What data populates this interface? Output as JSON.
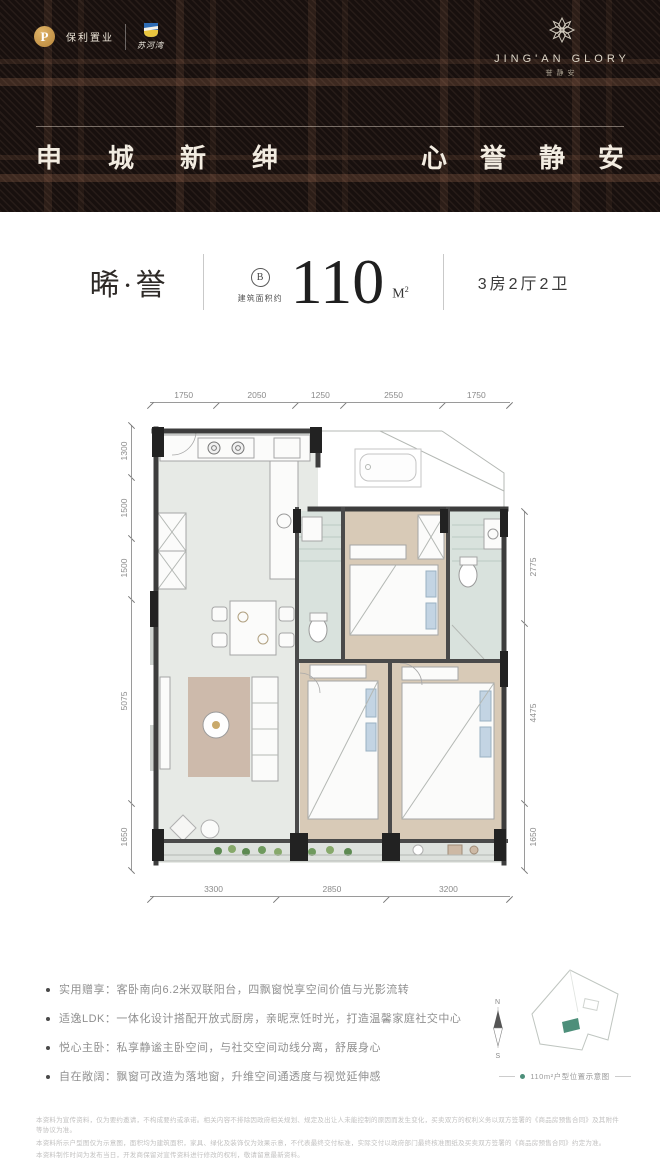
{
  "header": {
    "logo_poly_mark": "P",
    "logo_poly_label": "保利置业",
    "logo_partner_label": "苏河湾",
    "brand_name": "JING'AN GLORY",
    "brand_cn": "誉静安",
    "slogan_left": "申城新绅",
    "slogan_right": "心誉静安"
  },
  "title": {
    "product_name": "晞·誉",
    "unit_badge": "B",
    "area_label": "建筑面积约",
    "area_value": "110",
    "area_unit_main": "M",
    "area_unit_sup": "2",
    "layout": "3房2厅2卫"
  },
  "floorplan": {
    "dims_top": [
      "1750",
      "2050",
      "1250",
      "2550",
      "1750"
    ],
    "dims_left": [
      "1300",
      "1500",
      "1500",
      "5075",
      "1650"
    ],
    "dims_right": [
      "2775",
      "4475",
      "1650"
    ],
    "dims_bottom": [
      "3300",
      "2850",
      "3200"
    ]
  },
  "features": [
    "实用赠享：客卧南向6.2米双联阳台，四飘窗悦享空间价值与光影流转",
    "适逸LDK：一体化设计搭配开放式厨房，亲昵烹饪时光，打造温馨家庭社交中心",
    "悦心主卧：私享静谧主卧空间，与社交空间动线分离，舒展身心",
    "自在敞阔：飘窗可改造为落地窗，升维空间通透度与视觉延伸感"
  ],
  "miniplan": {
    "north": "N",
    "south": "S",
    "caption": "110m²户型位置示意图"
  },
  "disclaimer": [
    "本资料为宣传资料，仅为要约邀请，不构成要约或承诺。相关内容不排除因政府相关规划、规定及出让人未能控制的原因而发生变化，买卖双方的权利义务以双方签署的《商品房预售合同》及其附件等协议为准。",
    "本资料所示户型图仅为示意图，面积均为建筑面积，家具、绿化及装饰仅为效果示意，不代表最终交付标准，实际交付以政府部门最终核准图纸及买卖双方签署的《商品房预售合同》约定为准。",
    "本资料制作时间为发布当日，开发商保留对宣传资料进行修改的权利，敬请留意最新资料。"
  ],
  "colors": {
    "accent_gold": "#c59a4a",
    "unit_green": "#4d8f7a",
    "header_bg": "#18100e"
  }
}
